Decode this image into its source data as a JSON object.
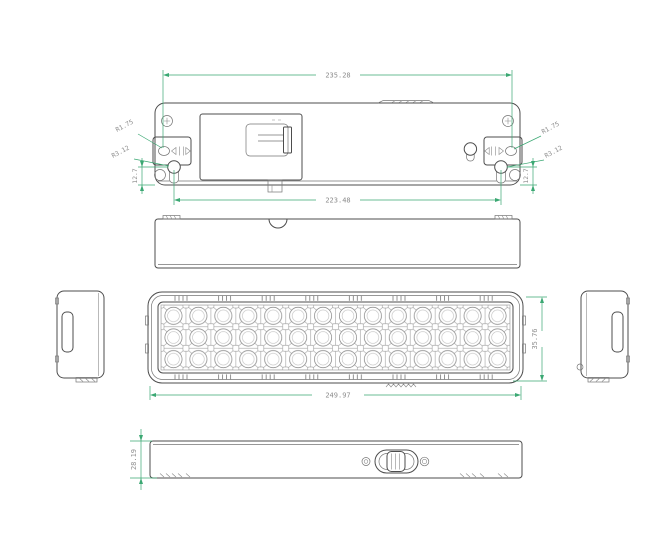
{
  "sheet": {
    "background": "#ffffff",
    "colors": {
      "outline": "#4d4d4d",
      "dimension_line": "#3ba873",
      "dimension_text": "#8c8c8c"
    },
    "views": {
      "back_view": {
        "dims": {
          "overall_width": "235.28",
          "mounting_span": "223.48",
          "slot_radius": "R1.75",
          "keyhole_radius": "R3.12",
          "keyhole_offset": "12.7"
        }
      },
      "front_view": {
        "dims": {
          "width": "249.97",
          "height": "35.76"
        }
      },
      "bottom_view": {
        "dims": {
          "height": "28.19"
        }
      }
    }
  }
}
